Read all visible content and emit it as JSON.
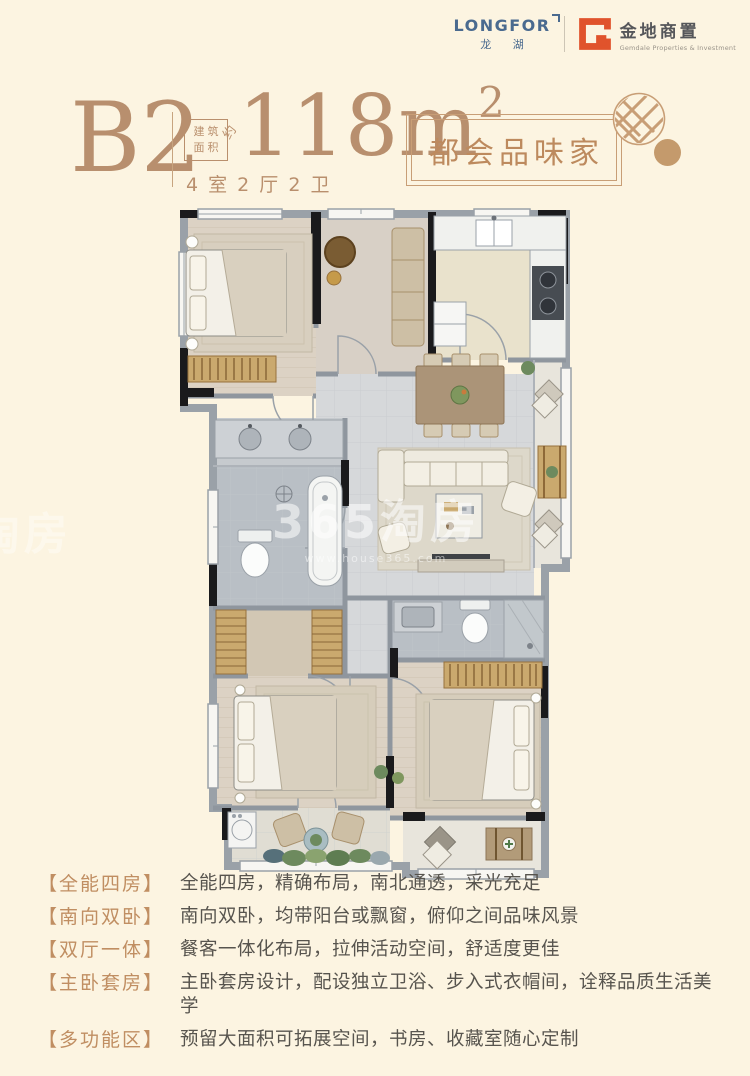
{
  "brand": {
    "longfor_en": "LONGFOR",
    "longfor_cn": "龙 湖",
    "gemdale_cn": "金地商置",
    "gemdale_en": "Gemdale Properties & Investment"
  },
  "header": {
    "unit_code": "B2",
    "area_box_line1": "建筑",
    "area_box_line2": "面积",
    "area_approx": "约",
    "area_value": "118m",
    "area_exponent": "2",
    "rooms_line": "4 室 2 厅 2 卫",
    "badge": "都会品味家"
  },
  "watermark": {
    "text": "365淘房",
    "site": "www.house365.com"
  },
  "features": [
    {
      "label": "【全能四房】",
      "text": "全能四房，精确布局，南北通透，采光充足"
    },
    {
      "label": "【南向双卧】",
      "text": "南向双卧，均带阳台或飘窗，俯仰之间品味风景"
    },
    {
      "label": "【双厅一体】",
      "text": "餐客一体化布局，拉伸活动空间，舒适度更佳"
    },
    {
      "label": "【主卧套房】",
      "text": "主卧套房设计，配设独立卫浴、步入式衣帽间，诠释品质生活美学"
    },
    {
      "label": "【多功能区】",
      "text": "预留大面积可拓展空间，书房、收藏室随心定制"
    }
  ],
  "colors": {
    "background": "#fcf4e1",
    "accent_tan": "#b98f6d",
    "badge_border": "#c89e76",
    "label_tan": "#c08e62",
    "body_gray": "#57544e",
    "longfor_blue": "#4a6a8f",
    "gemdale_orange": "#e0532c"
  }
}
